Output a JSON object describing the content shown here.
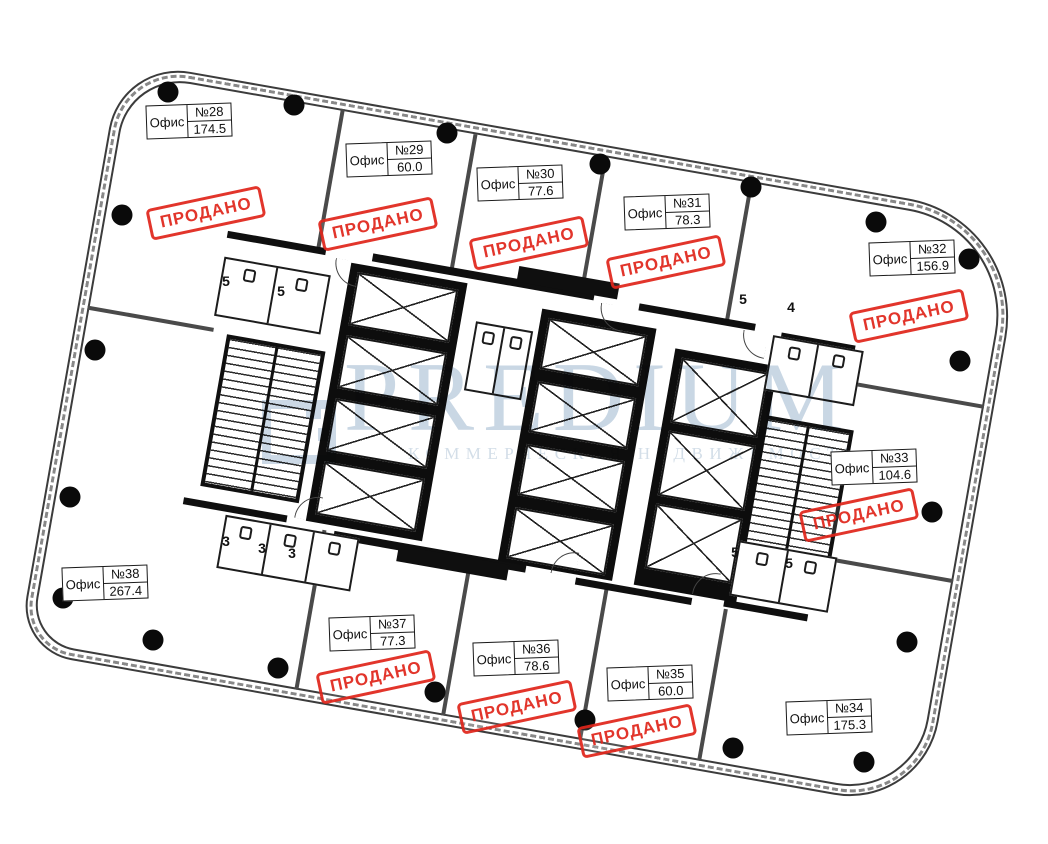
{
  "watermark": {
    "brand": "PREDIUM",
    "subtitle": "КОММЕРЧЕСКАЯ НЕДВИЖИМОСТЬ"
  },
  "stamp_text": "ПРОДАНО",
  "colors": {
    "sold_stamp": "#e0261c",
    "watermark_blue": "#ccd9e6",
    "wall_gray": "#4a4a4a",
    "core_black": "#0d0d0d"
  },
  "offices": [
    {
      "type_label": "Офис",
      "number": "№28",
      "area": "174.5",
      "sold": true
    },
    {
      "type_label": "Офис",
      "number": "№29",
      "area": "60.0",
      "sold": true
    },
    {
      "type_label": "Офис",
      "number": "№30",
      "area": "77.6",
      "sold": true
    },
    {
      "type_label": "Офис",
      "number": "№31",
      "area": "78.3",
      "sold": true
    },
    {
      "type_label": "Офис",
      "number": "№32",
      "area": "156.9",
      "sold": true
    },
    {
      "type_label": "Офис",
      "number": "№33",
      "area": "104.6",
      "sold": true
    },
    {
      "type_label": "Офис",
      "number": "№34",
      "area": "175.3",
      "sold": false
    },
    {
      "type_label": "Офис",
      "number": "№35",
      "area": "60.0",
      "sold": true
    },
    {
      "type_label": "Офис",
      "number": "№36",
      "area": "78.6",
      "sold": true
    },
    {
      "type_label": "Офис",
      "number": "№37",
      "area": "77.3",
      "sold": true
    },
    {
      "type_label": "Офис",
      "number": "№38",
      "area": "267.4",
      "sold": false
    }
  ],
  "core_rooms": [
    "5",
    "5",
    "5",
    "4",
    "3",
    "3",
    "3",
    "5",
    "5"
  ]
}
